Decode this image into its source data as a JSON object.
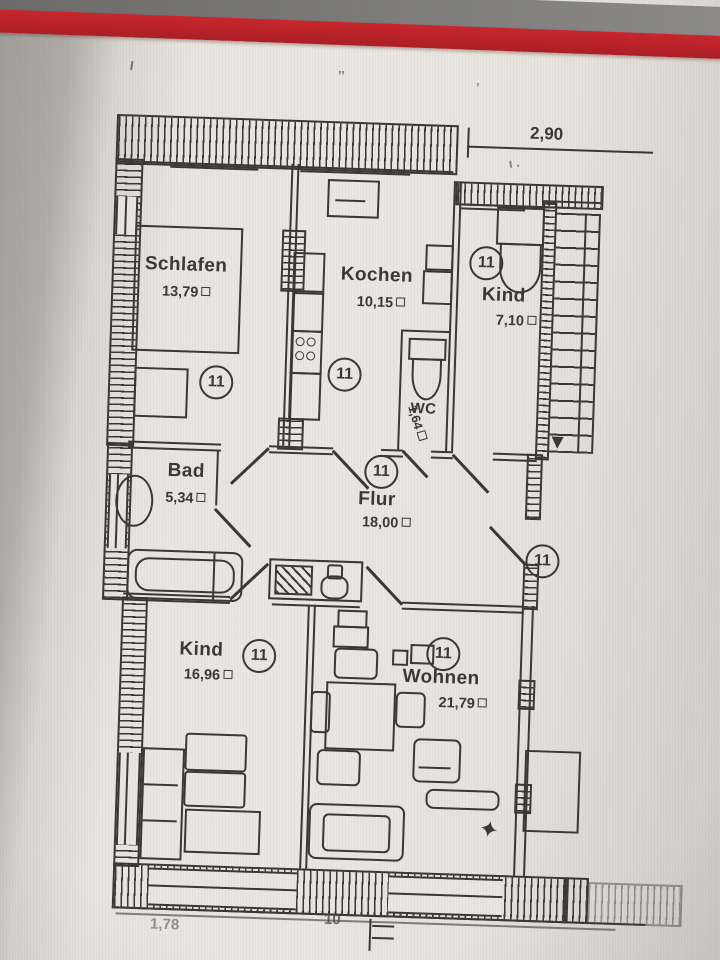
{
  "photo": {
    "paper_color": "#e9e6e0",
    "ink_color": "#3a3833",
    "red_bar_color": "#c1272d",
    "top_band_color": "#7b7a78"
  },
  "icons": {
    "sqm": "small-square",
    "star": "✦"
  },
  "marks": {
    "top_left": "I",
    "top_mid": "’’",
    "top_right": "’",
    "under_dim": "ι ."
  },
  "dimensions": {
    "top_width": "2,90",
    "bottom_left": "1,78",
    "bottom_mid": "10"
  },
  "unit_number": "11",
  "rooms": {
    "schlafen": {
      "name": "Schlafen",
      "area": "13,79"
    },
    "kochen": {
      "name": "Kochen",
      "area": "10,15"
    },
    "kind_top": {
      "name": "Kind",
      "area": "7,10"
    },
    "wc": {
      "name": "WC",
      "area": "1,64"
    },
    "bad": {
      "name": "Bad",
      "area": "5,34"
    },
    "flur": {
      "name": "Flur",
      "area": "18,00"
    },
    "kind_bottom": {
      "name": "Kind",
      "area": "16,96"
    },
    "wohnen": {
      "name": "Wohnen",
      "area": "21,79"
    }
  }
}
